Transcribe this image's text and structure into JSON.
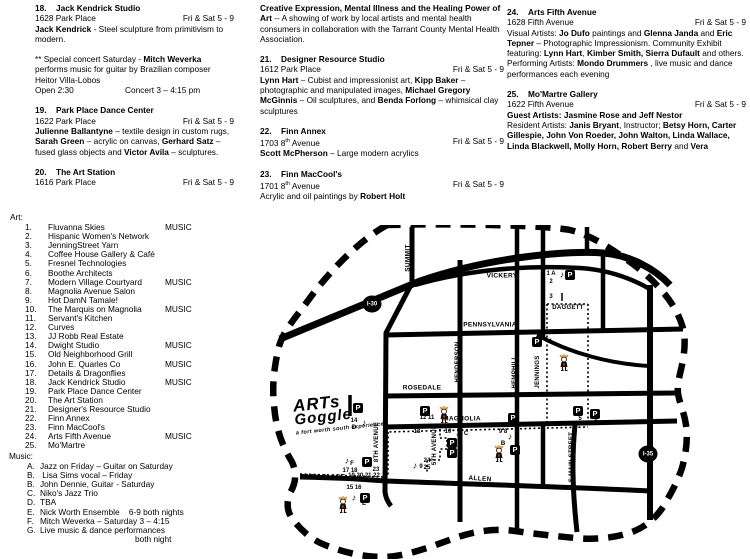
{
  "columns": [
    {
      "blocks": [
        {
          "type": "venue",
          "num": "18.",
          "name": "Jack Kendrick Studio",
          "address": [
            [
              "1628 Park Place",
              0
            ]
          ],
          "hours": "Fri & Sat 5 - 9",
          "desc": [
            [
              "Jack Kendrick",
              1
            ],
            [
              " - Steel sculpture from primitivism to modern.",
              0
            ]
          ]
        },
        {
          "type": "gap"
        },
        {
          "type": "para",
          "segs": [
            [
              "** Special concert Saturday  - ",
              0
            ],
            [
              "Mitch Weverka",
              1
            ],
            [
              " performs music for guitar by Brazilian composer Heitor Villa-Lobos",
              0
            ]
          ]
        },
        {
          "type": "split",
          "left": "Open 2:30",
          "right": "Concert 3 – 4:15 pm"
        },
        {
          "type": "gap"
        },
        {
          "type": "venue",
          "num": "19.",
          "name": "Park Place Dance Center",
          "address": [
            [
              "1622 Park Place",
              0
            ]
          ],
          "hours": "Fri & Sat 5 - 9",
          "desc": [
            [
              "Julienne Ballantyne",
              1
            ],
            [
              " – textile design in custom rugs, ",
              0
            ],
            [
              "Sarah Green",
              1
            ],
            [
              " – acrylic on canvas, ",
              0
            ],
            [
              "Gerhard Satz",
              1
            ],
            [
              " – fused glass objects and ",
              0
            ],
            [
              "Victor Avila",
              1
            ],
            [
              " – sculptures.",
              0
            ]
          ]
        },
        {
          "type": "gap"
        },
        {
          "type": "venue",
          "num": "20.",
          "name": "The Art Station",
          "address": [
            [
              "1616 Park Place",
              0
            ]
          ],
          "hours": "Fri & Sat 5 - 9",
          "desc": []
        }
      ]
    },
    {
      "blocks": [
        {
          "type": "para",
          "segs": [
            [
              "Creative Expression, Mental Illness and the Healing Power of Art",
              1
            ],
            [
              " -- A showing of work by local artists and mental health consumers in collaboration with the Tarrant County Mental Health Association.",
              0
            ]
          ]
        },
        {
          "type": "gap"
        },
        {
          "type": "venue",
          "num": "21.",
          "name": "Designer Resource Studio",
          "address": [
            [
              "1612 Park Place",
              0
            ]
          ],
          "hours": "Fri & Sat 5 - 9",
          "desc": [
            [
              "Lynn Hart",
              1
            ],
            [
              " – Cubist and impressionist art, ",
              0
            ],
            [
              "Kipp Baker",
              1
            ],
            [
              " – photographic and manipulated images, ",
              0
            ],
            [
              "Michael Gregory McGinnis",
              1
            ],
            [
              " – Oil sculptures, and ",
              0
            ],
            [
              "Benda Forlong",
              1
            ],
            [
              " – whimsical clay sculptures",
              0
            ]
          ]
        },
        {
          "type": "gap"
        },
        {
          "type": "venue",
          "num": "22.",
          "name": "Finn Annex",
          "address": [
            [
              "1703 8",
              0
            ],
            [
              "th",
              2
            ],
            [
              " Avenue",
              0
            ]
          ],
          "hours": "Fri & Sat 5 - 9",
          "desc": [
            [
              "Scott McPherson",
              1
            ],
            [
              "  – Large modern acrylics",
              0
            ]
          ]
        },
        {
          "type": "gap"
        },
        {
          "type": "venue",
          "num": "23.",
          "name": "Finn MacCool's",
          "address": [
            [
              "1701 8",
              0
            ],
            [
              "th",
              2
            ],
            [
              " Avenue",
              0
            ]
          ],
          "hours": "Fri & Sat 5 - 9",
          "desc": [
            [
              "Acrylic and oil paintings by ",
              0
            ],
            [
              "Robert Holt",
              1
            ]
          ]
        }
      ]
    },
    {
      "blocks": [
        {
          "type": "venue",
          "num": "24.",
          "name": "Arts Fifth Avenue",
          "address": [
            [
              "1628 Fifth Avenue",
              0
            ]
          ],
          "hours": "Fri & Sat 5 - 9",
          "desc": [
            [
              "Visual Artists: ",
              0
            ],
            [
              "Jo Dufo",
              1
            ],
            [
              " paintings and ",
              0
            ],
            [
              "Glenna Janda",
              1
            ],
            [
              " and ",
              0
            ],
            [
              "Eric Tepner",
              1
            ],
            [
              " – Photographic Impressionism. Community Exhibit featuring: ",
              0
            ],
            [
              "Lynn Hart",
              1
            ],
            [
              ", ",
              0
            ],
            [
              "Kimber Smith, Sierra Dufault",
              1
            ],
            [
              " and others.  Performing Artists: ",
              0
            ],
            [
              "Mondo Drummers",
              1
            ],
            [
              " , live music and dance performances each evening",
              0
            ]
          ]
        },
        {
          "type": "gap"
        },
        {
          "type": "venue",
          "num": "25.",
          "name": "Mo'Martre Gallery",
          "address": [
            [
              "1622 Fifth Avenue",
              0
            ]
          ],
          "hours": "Fri & Sat 5 - 9",
          "desc": [
            [
              "Guest Artists:  Jasmine Rose and Jeff Nestor",
              1
            ],
            [
              "",
              3
            ],
            [
              "Resident Artists:  ",
              0
            ],
            [
              "Janis Bryant",
              1
            ],
            [
              ", Instructor; ",
              0
            ],
            [
              "Betsy Horn, Carter Gillespie, John Von Roeder, John Walton, Linda Wallace, Linda Blackwell, Molly Horn, Robert Berry",
              1
            ],
            [
              " and ",
              0
            ],
            [
              "Vera",
              1
            ]
          ]
        }
      ]
    }
  ],
  "art": {
    "title": "Art:",
    "items": [
      {
        "num": "1.",
        "label": "Fluvanna Skies",
        "tag": "MUSIC"
      },
      {
        "num": "2.",
        "label": "Hispanic Women's Network"
      },
      {
        "num": "3.",
        "label": "JenningStreet Yarn"
      },
      {
        "num": "4.",
        "label": "Coffee House Gallery & Café"
      },
      {
        "num": "5.",
        "label": "Fresnel Technologies"
      },
      {
        "num": "6.",
        "label": "Boothe Architects"
      },
      {
        "num": "7.",
        "label": "Modern Village Courtyard",
        "tag": "MUSIC"
      },
      {
        "num": "8.",
        "label": "Magnolia Avenue Salon"
      },
      {
        "num": "9.",
        "label": "Hot DamN Tamale!"
      },
      {
        "num": "10.",
        "label": "The Marquis on Magnolia",
        "tag": "MUSIC"
      },
      {
        "num": "11.",
        "label": "Servant's Kitchen"
      },
      {
        "num": "12.",
        "label": "Curves"
      },
      {
        "num": "13.",
        "label": "JJ Robb Real Estate"
      },
      {
        "num": "14.",
        "label": "Dwight Studio",
        "tag": "MUSIC"
      },
      {
        "num": "15.",
        "label": "Old Neighborhood Grill"
      },
      {
        "num": "16.",
        "label": "John E. Quarles Co",
        "tag": "MUSIC"
      },
      {
        "num": "17.",
        "label": "Details & Dragonflies"
      },
      {
        "num": "18.",
        "label": "Jack Kendrick Studio",
        "tag": "MUSIC"
      },
      {
        "num": "19.",
        "label": "Park Place Dance Center"
      },
      {
        "num": "20.",
        "label": "The Art Station"
      },
      {
        "num": "21.",
        "label": "Designer's Resource Studio"
      },
      {
        "num": "22.",
        "label": "Finn Annex"
      },
      {
        "num": "23.",
        "label": "Finn MacCool's"
      },
      {
        "num": "24.",
        "label": "Arts Fifth Avenue",
        "tag": "MUSIC"
      },
      {
        "num": "25.",
        "label": "Mo'Martre"
      }
    ]
  },
  "music": {
    "title": "Music:",
    "items": [
      {
        "letter": "A.",
        "label": "Jazz on Friday – Guitar on Saturday"
      },
      {
        "letter": "B.",
        "label": " Lisa Sims vocal – Friday"
      },
      {
        "letter": "B.",
        "label": "John Dennie, Guitar - Saturday"
      },
      {
        "letter": "C.",
        "label": "Niko's Jazz Trio"
      },
      {
        "letter": "D.",
        "label": "TBA"
      },
      {
        "letter": "E.",
        "label": "Nick Worth Ensemble    6-9 both nights"
      },
      {
        "letter": "F.",
        "label": "Mitch Weverka – Saturday 3 – 4:15"
      },
      {
        "letter": "G.",
        "label": "Live music & dance performances"
      }
    ],
    "tail": "both night"
  },
  "map": {
    "logo": {
      "line1": "ARTs",
      "line2": "Goggle",
      "tagline": "a fort worth south experience"
    },
    "note_glyph": "♪",
    "parking_glyph": "P",
    "shields": [
      {
        "label": "I-30",
        "x": 102,
        "y": 79
      },
      {
        "label": "I-35",
        "x": 378,
        "y": 229
      }
    ],
    "streets": [
      {
        "label": "SUMMIT",
        "x": 138,
        "y": 33,
        "rot": -90,
        "size": 6.5
      },
      {
        "label": "VICKERY",
        "x": 232,
        "y": 51,
        "size": 6.5
      },
      {
        "label": "PENNSYLVANIA",
        "x": 220,
        "y": 100,
        "size": 6.5
      },
      {
        "label": "HENDERSON",
        "x": 188,
        "y": 137,
        "rot": -90,
        "size": 6
      },
      {
        "label": "ROSEDALE",
        "x": 152,
        "y": 163,
        "size": 6.5
      },
      {
        "label": "DAGGETT",
        "x": 298,
        "y": 83,
        "size": 6
      },
      {
        "label": "HEMPHILL",
        "x": 245,
        "y": 147,
        "rot": -90,
        "size": 6
      },
      {
        "label": "JENNINGS",
        "x": 268,
        "y": 147,
        "rot": -90,
        "size": 6
      },
      {
        "label": "MAGNOLIA",
        "x": 192,
        "y": 194,
        "size": 6.5
      },
      {
        "label": "8TH AVENUE",
        "x": 107,
        "y": 217,
        "rot": -90,
        "size": 6
      },
      {
        "label": "5TH AVENUE",
        "x": 165,
        "y": 220,
        "rot": -90,
        "size": 6
      },
      {
        "label": "S MAIN STREET",
        "x": 302,
        "y": 232,
        "rot": -90,
        "size": 6
      },
      {
        "label": "ALLEN",
        "x": 210,
        "y": 254,
        "rot": 4,
        "size": 6.5
      },
      {
        "label": "PARK PLACE",
        "x": 53,
        "y": 252,
        "size": 6.5
      }
    ],
    "venues": [
      {
        "label": "1 A",
        "x": 281,
        "y": 49
      },
      {
        "label": "2",
        "x": 281,
        "y": 57
      },
      {
        "label": "3",
        "x": 281,
        "y": 72
      },
      {
        "label": "4",
        "x": 280,
        "y": 117
      },
      {
        "label": "5",
        "x": 310,
        "y": 194
      },
      {
        "label": "6",
        "x": 326,
        "y": 197
      },
      {
        "label": "9 8",
        "x": 233,
        "y": 207
      },
      {
        "label": "7",
        "x": 246,
        "y": 206
      },
      {
        "label": "B",
        "x": 233,
        "y": 219
      },
      {
        "label": "10",
        "x": 178,
        "y": 207
      },
      {
        "label": "C",
        "x": 196,
        "y": 209
      },
      {
        "label": "12 11",
        "x": 157,
        "y": 193
      },
      {
        "label": "13",
        "x": 147,
        "y": 207
      },
      {
        "label": "14",
        "x": 84,
        "y": 196
      },
      {
        "label": "D",
        "x": 84,
        "y": 203
      },
      {
        "label": "24",
        "x": 157,
        "y": 236
      },
      {
        "label": "25",
        "x": 157,
        "y": 243
      },
      {
        "label": "9",
        "x": 151,
        "y": 242
      },
      {
        "label": "15 16",
        "x": 84,
        "y": 263
      },
      {
        "label": "E",
        "x": 94,
        "y": 279
      },
      {
        "label": "17 18",
        "x": 80,
        "y": 246
      },
      {
        "label": "F",
        "x": 82,
        "y": 239
      },
      {
        "label": "19 20 21 22",
        "x": 94,
        "y": 251
      },
      {
        "label": "23",
        "x": 106,
        "y": 245
      }
    ],
    "notes": [
      [
        292,
        50
      ],
      [
        94,
        198
      ],
      [
        77,
        236
      ],
      [
        84,
        273
      ],
      [
        145,
        241
      ],
      [
        188,
        208
      ],
      [
        240,
        212
      ]
    ],
    "parking": [
      [
        300,
        50
      ],
      [
        267,
        117
      ],
      [
        88,
        183
      ],
      [
        155,
        186
      ],
      [
        243,
        193
      ],
      [
        308,
        186
      ],
      [
        325,
        189
      ],
      [
        182,
        218
      ],
      [
        182,
        228
      ],
      [
        245,
        225
      ],
      [
        97,
        237
      ],
      [
        95,
        273
      ]
    ],
    "mascots": [
      [
        168,
        181
      ],
      [
        223,
        220
      ],
      [
        288,
        129
      ],
      [
        67,
        271
      ]
    ]
  }
}
